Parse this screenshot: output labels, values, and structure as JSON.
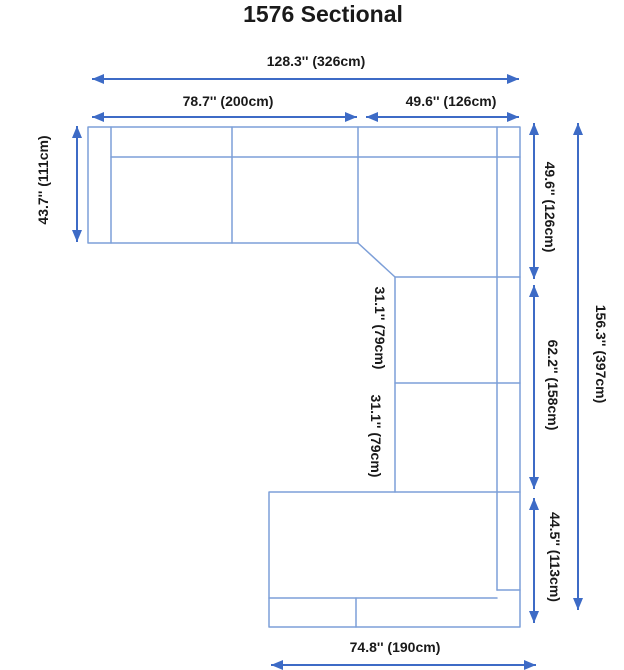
{
  "title": "1576 Sectional",
  "labels": {
    "overall_width": "128.3'' (326cm)",
    "left_section_width": "78.7'' (200cm)",
    "corner_width": "49.6'' (126cm)",
    "left_depth": "43.7'' (111cm)",
    "right_upper_depth": "49.6'' (126cm)",
    "total_depth": "156.3'' (397cm)",
    "right_middle_depth": "62.2'' (158cm)",
    "upper_armless_seat": "31.1'' (79cm)",
    "lower_armless_seat": "31.1'' (79cm)",
    "chaise_depth": "44.5'' (113cm)",
    "chaise_width": "74.8'' (190cm)"
  },
  "colors": {
    "arrow": "#3D6BC6",
    "outline": "#7D9FD8",
    "text": "#1A1A1A"
  }
}
